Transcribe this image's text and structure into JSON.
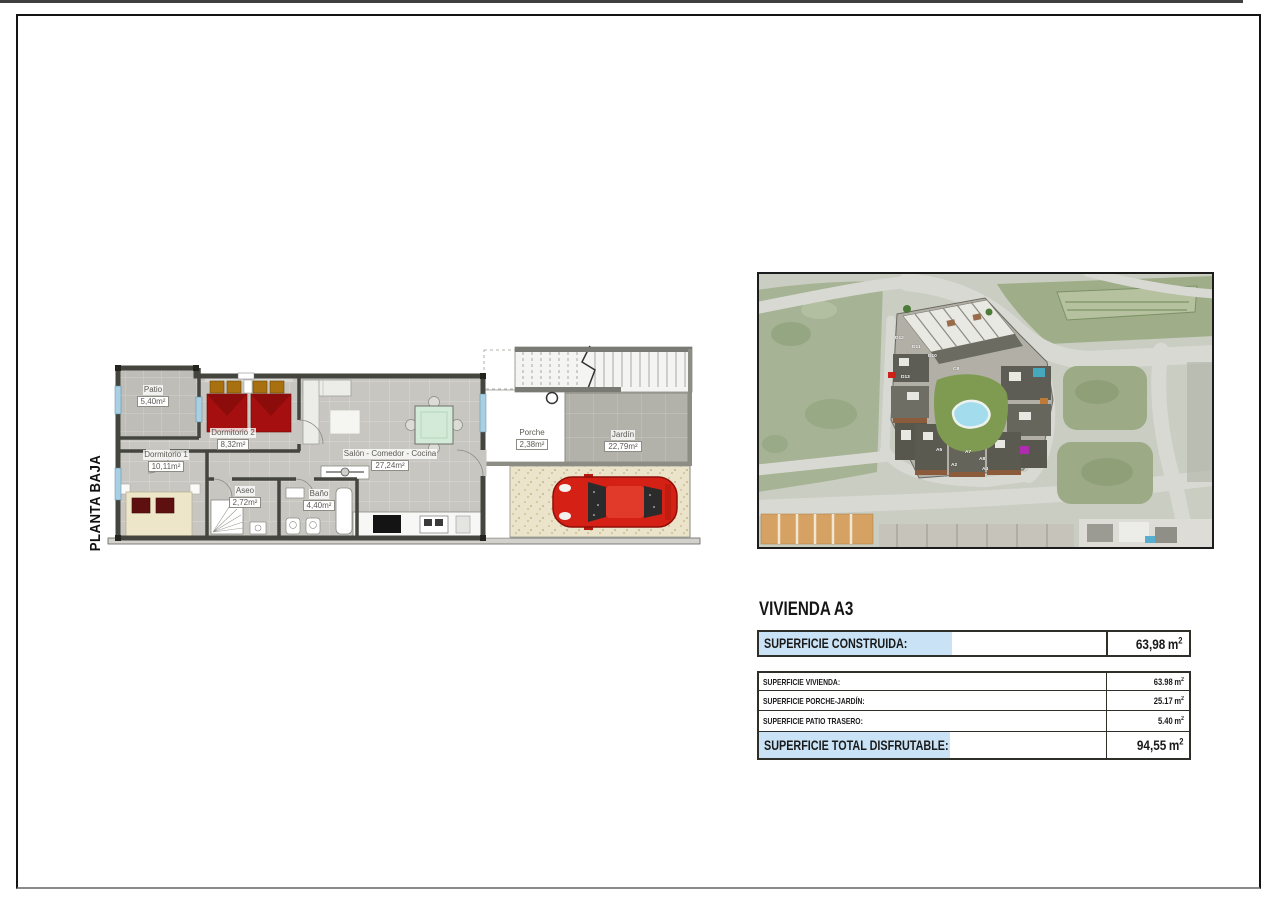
{
  "floor_plan": {
    "floor_label": "PLANTA BAJA",
    "rooms": {
      "patio": {
        "name": "Patio",
        "area": "5,40m²"
      },
      "dormitorio2": {
        "name": "Dormitorio 2",
        "area": "8,32m²"
      },
      "dormitorio1": {
        "name": "Dormitorio 1",
        "area": "10,11m²"
      },
      "aseo": {
        "name": "Aseo",
        "area": "2,72m²"
      },
      "bano": {
        "name": "Baño",
        "area": "4,40m²"
      },
      "salon": {
        "name": "Salón - Comedor - Cocina",
        "area": "27,24m²"
      },
      "porche": {
        "name": "Porche",
        "area": "2,38m²"
      },
      "jardin": {
        "name": "Jardín",
        "area": "22,79m²"
      }
    }
  },
  "site_map": {
    "unit_labels": [
      "D12",
      "D11",
      "D10",
      "C8",
      "D13",
      "A5",
      "A7",
      "A8",
      "A2",
      "A4"
    ]
  },
  "info": {
    "title": "VIVIENDA A3",
    "construida": {
      "label": "SUPERFICIE CONSTRUIDA:",
      "value": "63,98",
      "unit": "m",
      "sup": "2"
    },
    "rows": [
      {
        "label": "SUPERFICIE VIVIENDA:",
        "value": "63.98",
        "unit": "m",
        "sup": "2"
      },
      {
        "label": "SUPERFICIE PORCHE-JARDÍN:",
        "value": "25.17",
        "unit": "m",
        "sup": "2"
      },
      {
        "label": "SUPERFICIE PATIO TRASERO:",
        "value": "5.40",
        "unit": "m",
        "sup": "2"
      }
    ],
    "total": {
      "label": "SUPERFICIE TOTAL DISFRUTABLE:",
      "value": "94,55",
      "unit": "m",
      "sup": "2"
    }
  },
  "colors": {
    "highlight_blue": "#c9e2f5",
    "bed_red": "#a50f0f",
    "car_red": "#d42015",
    "pool_blue": "#a3dced",
    "lawn_green": "#7e9b51",
    "dining_table_green": "#d4ead9",
    "window_blue": "#a9cfe2"
  }
}
